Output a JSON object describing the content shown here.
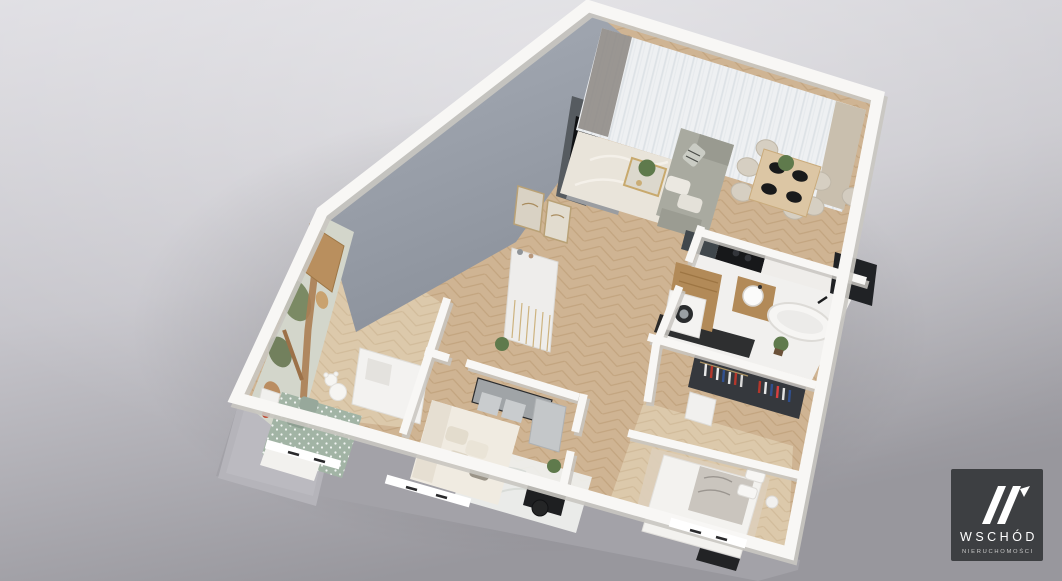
{
  "scene": {
    "type": "isometric-3d-floor-plan-render",
    "rooms": [
      "living-dining-room",
      "kitchen",
      "hallway",
      "bathroom",
      "wardrobe",
      "bedroom",
      "kids-room",
      "study-room",
      "balcony"
    ],
    "furniture": [
      "gray-sofa",
      "coffee-table",
      "dining-table",
      "dining-chairs",
      "tv-media-wall",
      "hall-console",
      "wall-pictures",
      "kitchen-counter",
      "cooktop",
      "fridge",
      "washing-machine",
      "washbasin",
      "bathtub",
      "clothes-rack",
      "double-bed",
      "kids-bed",
      "teddy-bear",
      "wall-mural",
      "wooden-door",
      "study-sofa",
      "desk-with-stools",
      "black-desk-chair",
      "rugs",
      "plants",
      "windows"
    ]
  },
  "watermark": {
    "mark": "W",
    "name": "WSCHÓD",
    "tagline": "NIERUCHOMOŚCI"
  },
  "colors": {
    "bg_top": "#dedde2",
    "bg_mid": "#c6c5cb",
    "bg_dark": "#98979d",
    "slab": "#a3a2a8",
    "balcony": "#b5b4ba",
    "wall_white": "#f8f7f5",
    "wall_shadow": "#c9c6c1",
    "feature_wall_top": "#a8aeb8",
    "feature_wall_bottom": "#8b919b",
    "floor_base": "#cfb493",
    "floor_line": "#b7976e",
    "floor_light": "#dcc9ab",
    "floor_light_line": "#c6ad8a",
    "bath_floor": "#f1f0ee",
    "tile_black": "#1d1e20",
    "rug_cream": "#e9e4da",
    "rug_white": "#f0f1ef",
    "rug_beige": "#dccfb9",
    "sofa_gray": "#a9aaa0",
    "cushion_white": "#ebe8e1",
    "sofa_cream": "#f0ebe1",
    "wood_dark": "#b28a58",
    "wood_table": "#dcc6a4",
    "gold": "#c8a96d",
    "counter_graphite": "#40474c",
    "appliance_black": "#17181a",
    "closet_dark": "#35383d",
    "bed_white": "#f3f2ef",
    "blanket_marble": "#cac5be",
    "kids_green": "#a2b4a5",
    "mural_bg": "#d3d6cb",
    "mural_green": "#77865f",
    "mural_brown": "#aa7a4e",
    "curtain_beige": "#c9bfae",
    "curtain_taupe": "#908c87",
    "door_wood": "#b98f5e",
    "plant_green": "#5f7a4c",
    "logo_bg": "#3a3c3f",
    "logo_text": "#ffffff",
    "logo_sub": "#c9c9c9"
  }
}
